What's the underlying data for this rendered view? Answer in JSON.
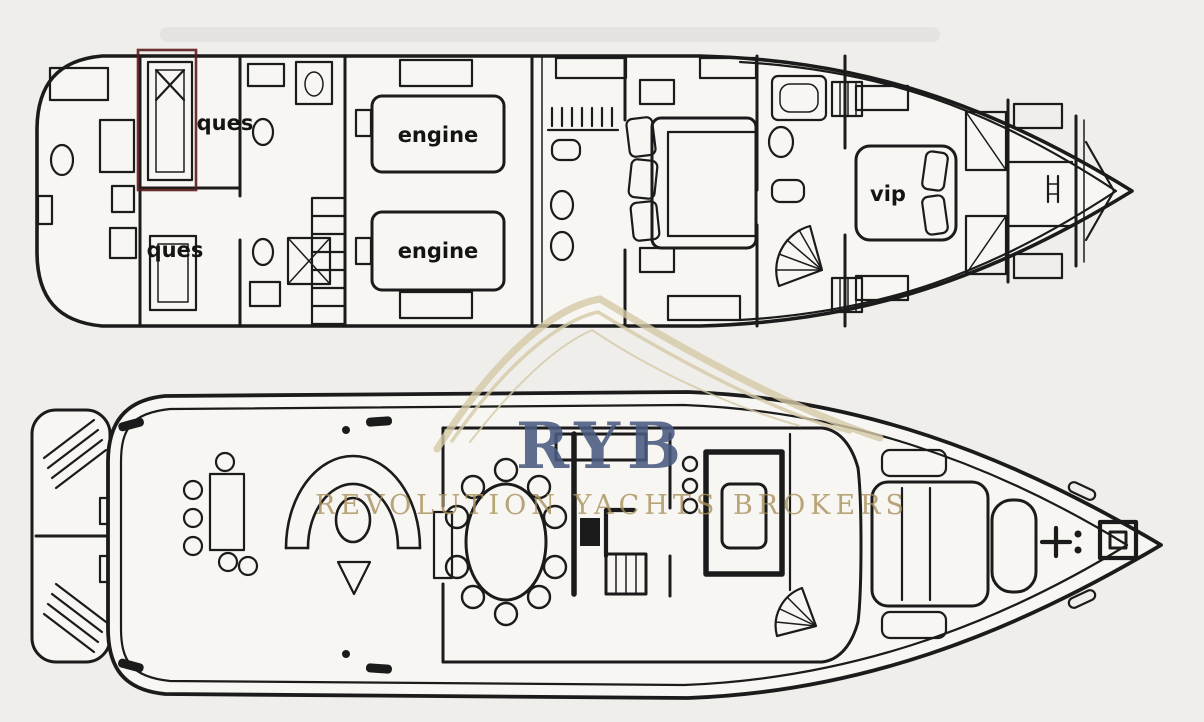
{
  "watermark": {
    "monogram": "RYB",
    "brand": "REVOLUTION YACHTS BROKERS",
    "monogram_color": "#4a5b80",
    "brand_color": "#a8905a",
    "swoosh_color": "#d5c9a6"
  },
  "lower_deck": {
    "labels": {
      "guest_cabin_aft_port": "ques",
      "guest_cabin_aft_starboard": "ques",
      "engine_port": "engine",
      "engine_starboard": "engine",
      "vip_cabin": "vip"
    }
  },
  "colors": {
    "background": "#efeeea",
    "ink": "#1b1b1b",
    "annotation_red": "#5c1c1c"
  }
}
